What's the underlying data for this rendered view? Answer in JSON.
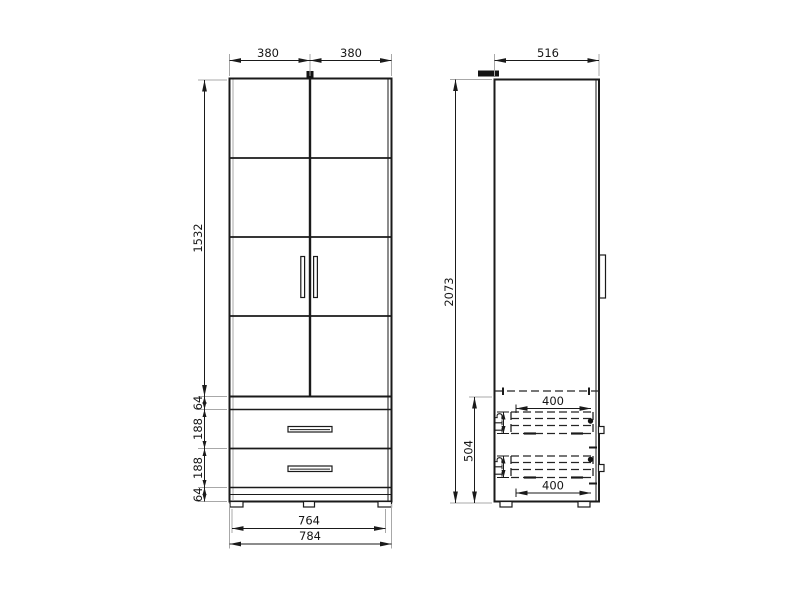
{
  "colors": {
    "line": "#1a1a1a",
    "extension_line": "#a8a8a8",
    "hidden_line": "#242424",
    "background": "#ffffff"
  },
  "front_view": {
    "dim_door_width_left": "380",
    "dim_door_width_right": "380",
    "dim_door_section_height": "1532",
    "dim_chain": [
      "64",
      "188",
      "188",
      "64"
    ],
    "dim_inner_width": "764",
    "dim_overall_width": "784"
  },
  "side_view": {
    "dim_depth": "516",
    "dim_overall_height": "2073",
    "dim_drawer_section_height": "504",
    "dim_drawer1_depth": "400",
    "dim_drawer1_height": "115",
    "dim_drawer2_height": "115",
    "dim_drawer2_depth": "400"
  }
}
